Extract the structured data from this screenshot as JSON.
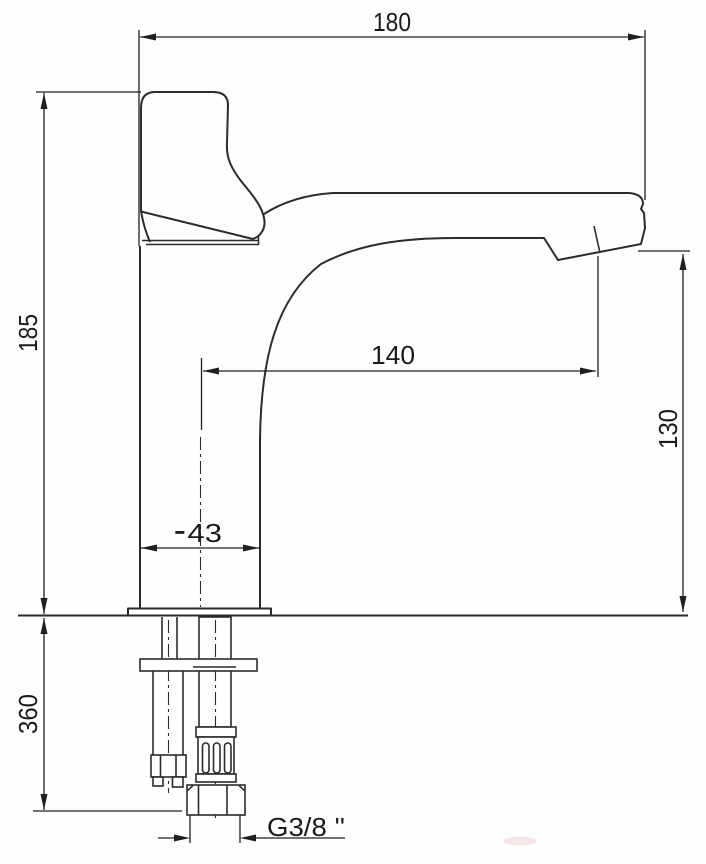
{
  "page": {
    "background_color": "#ffffff",
    "line_color": "#2b2b2b",
    "watermark_color": "#e8a6b0"
  },
  "drawing": {
    "type": "technical-dimension-drawing",
    "subject": "Single-lever basin mixer faucet, side elevation with under-counter mounting hardware",
    "units": "mm",
    "dimensions": {
      "top_width": "180",
      "body_height": "185",
      "spout_reach": "140",
      "spout_outlet_height": "130",
      "base_diameter": "⁃43",
      "below_counter_length": "360",
      "supply_thread": "G3/8 ''"
    }
  }
}
